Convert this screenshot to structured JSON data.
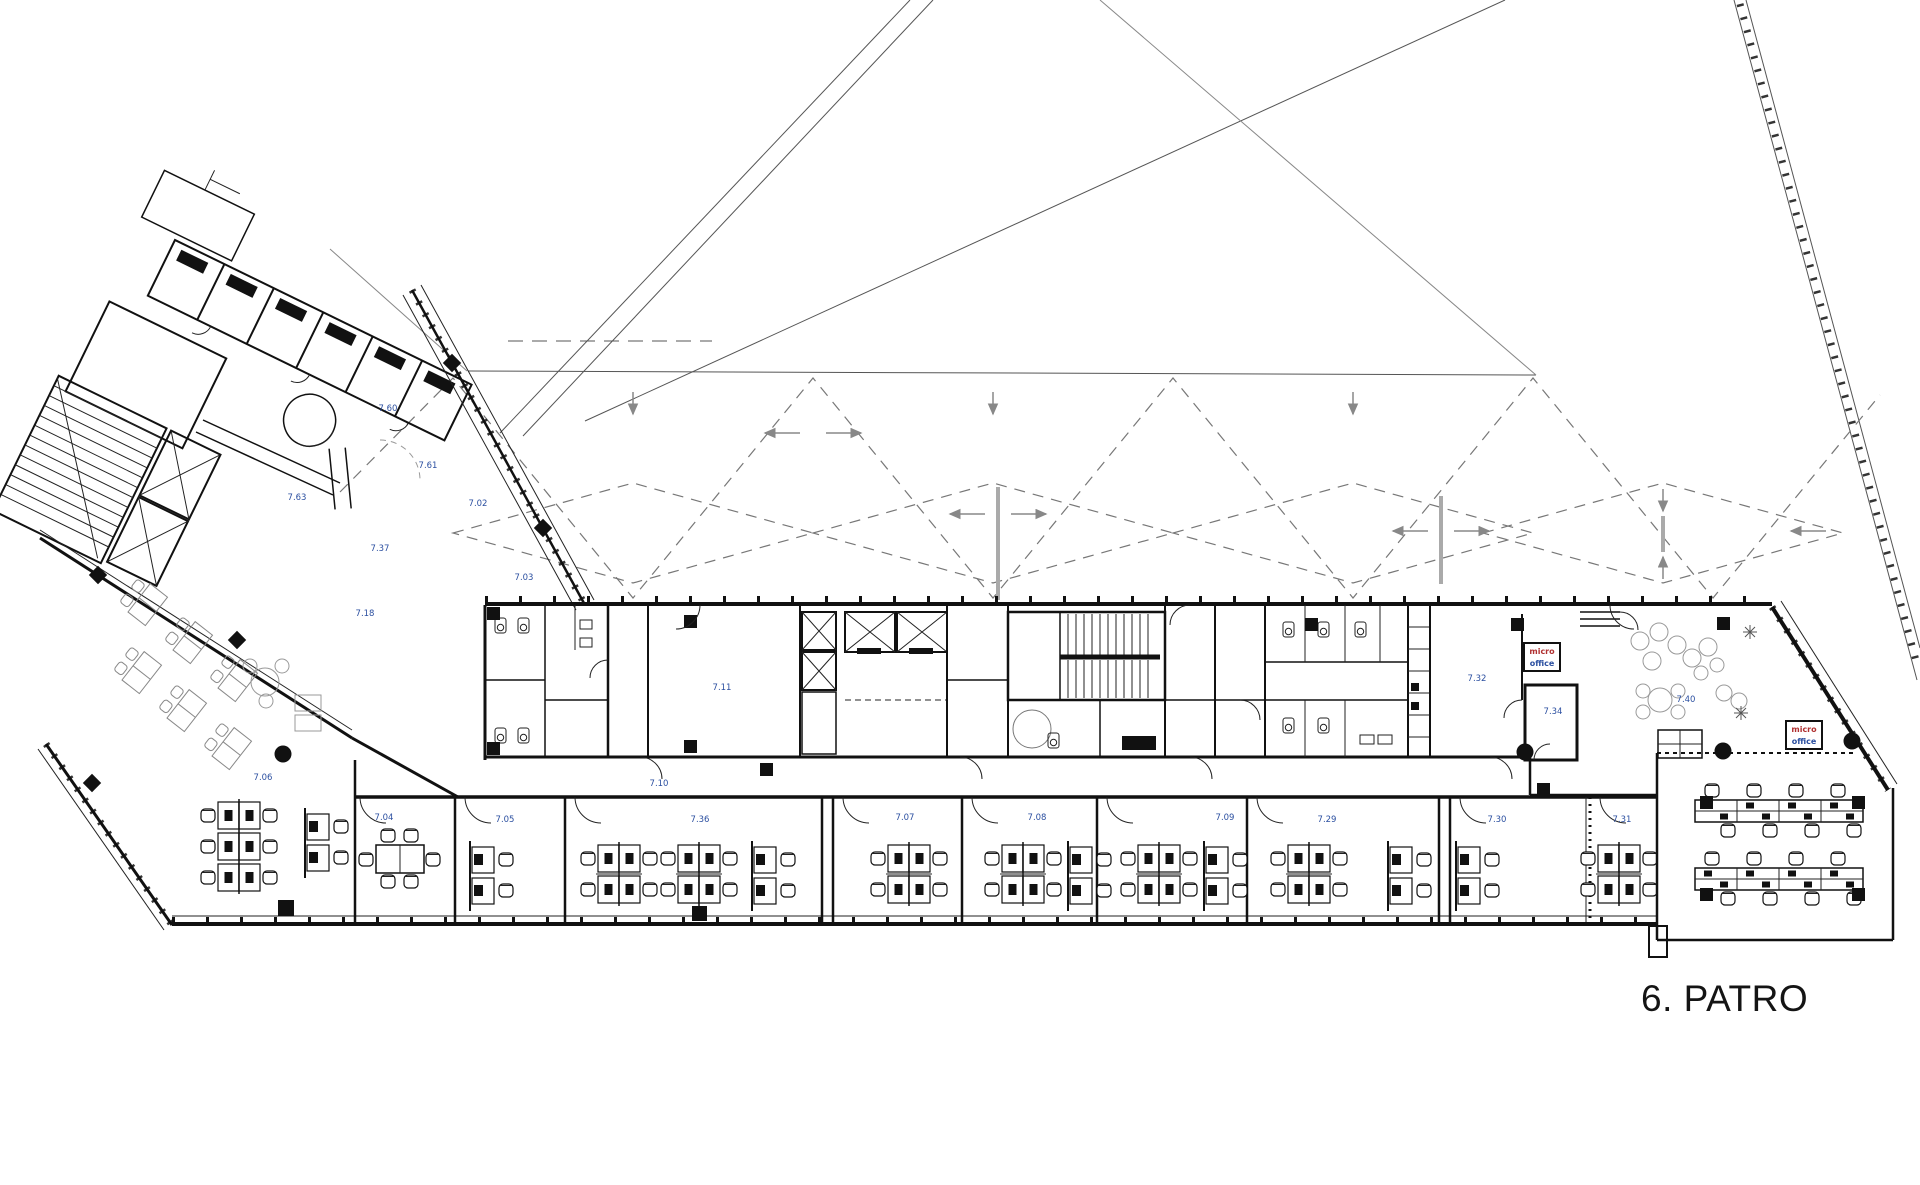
{
  "meta": {
    "drawing_type": "architectural floor plan",
    "language": "Czech"
  },
  "title": {
    "floor_label": "6. PATRO"
  },
  "colors": {
    "paper": "#ffffff",
    "ink": "#111111",
    "room_label_blue": "#2b4fa0",
    "annotation_red": "#b03030",
    "light_furniture_gray": "#999999",
    "roof_bracing_gray": "#777777"
  },
  "annotations": {
    "micro_office_boxes": [
      {
        "line1": "micro",
        "line2": "office",
        "x": 1524,
        "y": 643
      },
      {
        "line1": "micro",
        "line2": "office",
        "x": 1786,
        "y": 721
      }
    ],
    "room_labels": [
      {
        "text": "7.60",
        "x": 388,
        "y": 411
      },
      {
        "text": "7.61",
        "x": 428,
        "y": 468
      },
      {
        "text": "7.63",
        "x": 297,
        "y": 500
      },
      {
        "text": "7.02",
        "x": 478,
        "y": 506
      },
      {
        "text": "7.03",
        "x": 524,
        "y": 580
      },
      {
        "text": "7.37",
        "x": 380,
        "y": 551
      },
      {
        "text": "7.18",
        "x": 365,
        "y": 616
      },
      {
        "text": "7.11",
        "x": 722,
        "y": 690
      },
      {
        "text": "7.10",
        "x": 659,
        "y": 786
      },
      {
        "text": "7.06",
        "x": 263,
        "y": 780
      },
      {
        "text": "7.04",
        "x": 384,
        "y": 820
      },
      {
        "text": "7.05",
        "x": 505,
        "y": 822
      },
      {
        "text": "7.36",
        "x": 700,
        "y": 822
      },
      {
        "text": "7.07",
        "x": 905,
        "y": 820
      },
      {
        "text": "7.08",
        "x": 1037,
        "y": 820
      },
      {
        "text": "7.09",
        "x": 1225,
        "y": 820
      },
      {
        "text": "7.29",
        "x": 1327,
        "y": 822
      },
      {
        "text": "7.30",
        "x": 1497,
        "y": 822
      },
      {
        "text": "7.31",
        "x": 1622,
        "y": 822
      },
      {
        "text": "7.32",
        "x": 1477,
        "y": 681
      },
      {
        "text": "7.34",
        "x": 1553,
        "y": 714
      },
      {
        "text": "7.40",
        "x": 1686,
        "y": 702
      }
    ]
  }
}
